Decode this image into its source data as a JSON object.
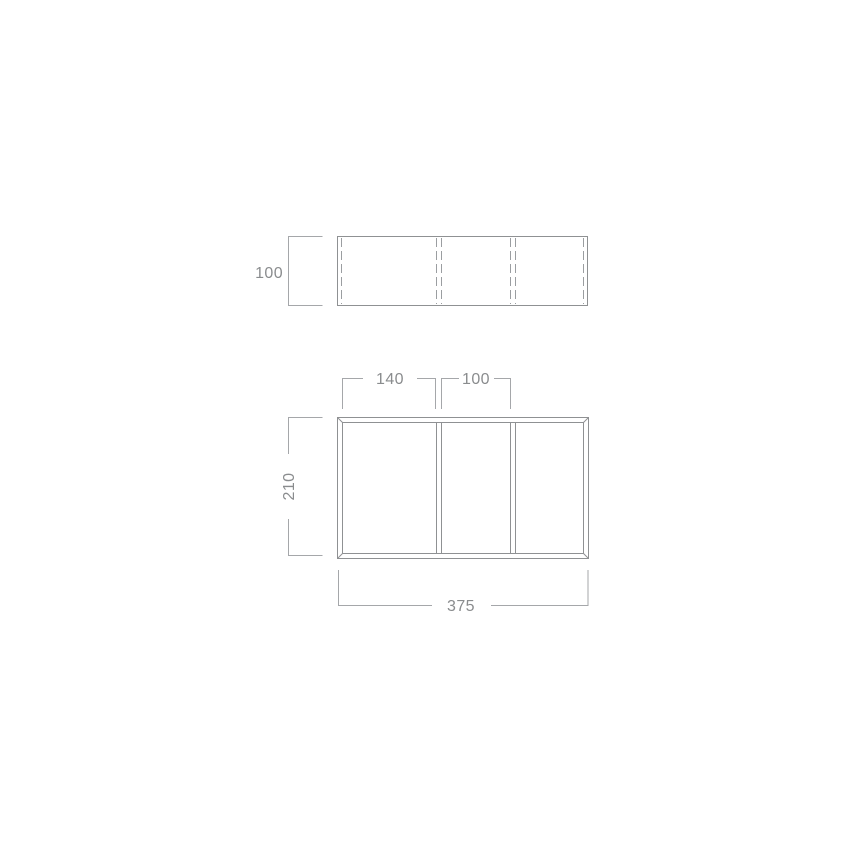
{
  "canvas": {
    "background": "#ffffff"
  },
  "colors": {
    "object_line": "#8f9193",
    "hidden_line": "#9b9ea1",
    "dimension_line": "#a5a7aa",
    "label_text": "#8a8c8e"
  },
  "side_view": {
    "height_dim": {
      "label": "100"
    }
  },
  "plan_view": {
    "compartment_dims": [
      {
        "label": "140"
      },
      {
        "label": "100"
      }
    ],
    "depth_dim": {
      "label": "210"
    },
    "width_dim": {
      "label": "375"
    }
  }
}
